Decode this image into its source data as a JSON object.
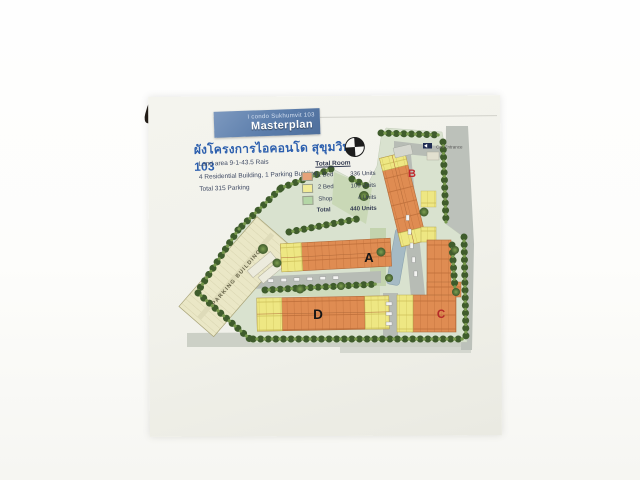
{
  "header": {
    "project_line": "I condo Sukhumvit 103",
    "masterplan_label": "Masterplan",
    "thai_title": "ผังโครงการไอคอนโด สุขุมวิท 103"
  },
  "site_info": {
    "land_area": "Land area 9-1-43.5 Rais",
    "buildings": "4 Residential Building, 1 Parking Building",
    "parking": "Total 315 Parking"
  },
  "legend": {
    "title": "Total Room",
    "rows": [
      {
        "label": "1 Bed",
        "value": "336 Units",
        "swatch": "#e6a379"
      },
      {
        "label": "2 Bed",
        "value": "100 Units",
        "swatch": "#f1eb96"
      },
      {
        "label": "Shop",
        "value": "4 Units",
        "swatch": "#b4d6a6"
      }
    ],
    "total_label": "Total",
    "total_value": "440 Units"
  },
  "plan": {
    "building_a_label": "A",
    "building_b_label": "B",
    "building_c_label": "C",
    "building_d_label": "D",
    "parking_building_label": "PARKING BUILDING",
    "car_entrance_label": "Car Entrance",
    "compass_icon": "north-compass"
  },
  "colors": {
    "header_box_blue": "#5b7dab",
    "thai_title_blue": "#2c5fae",
    "site_ground_green": "#d9e2cf",
    "residential_orange": "#df8c52",
    "residential_yellow": "#eee783",
    "parking_cream": "#eae7c6",
    "tree_green": "#3f5c2c",
    "road_gray": "#b7bcb5",
    "pool_blue": "#a5bac4",
    "label_red": "#c1272d"
  }
}
